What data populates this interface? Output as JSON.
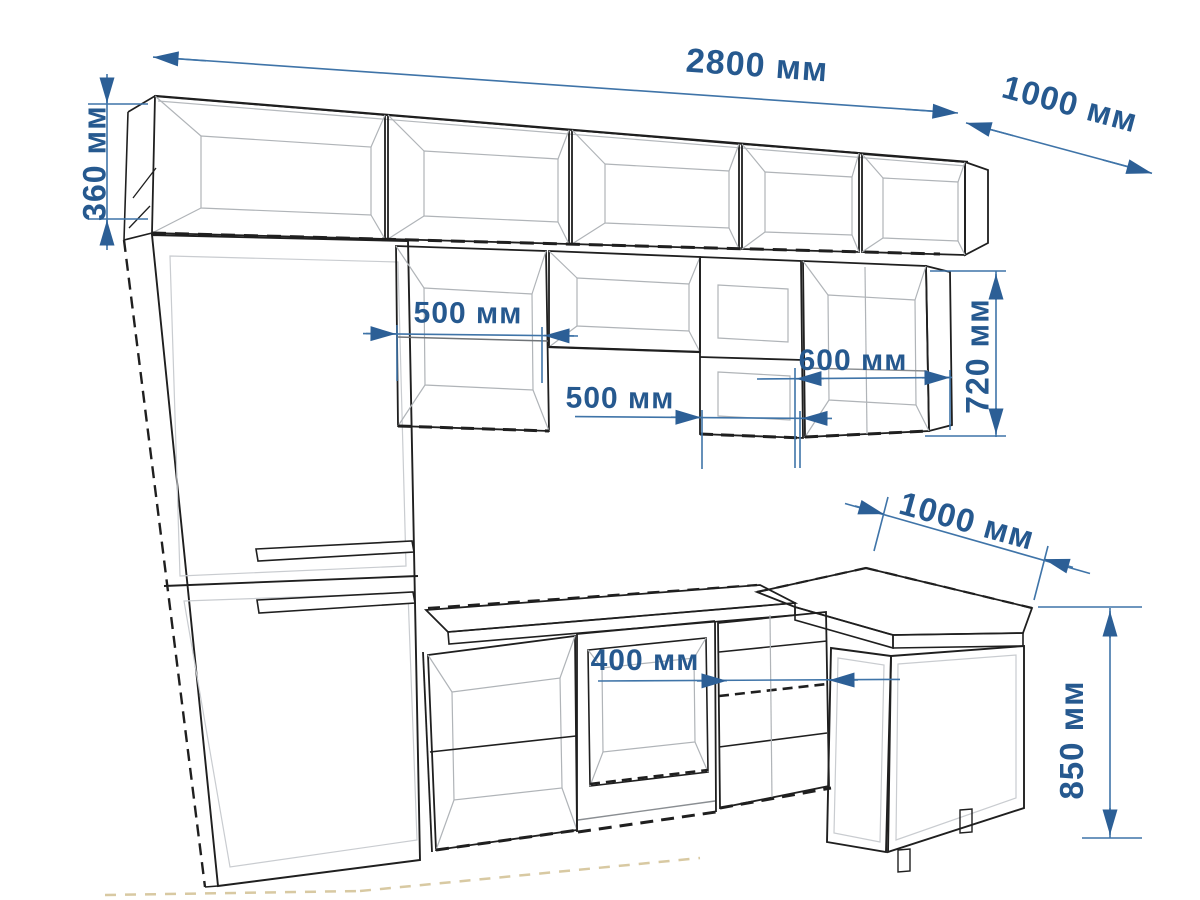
{
  "diagram": {
    "kind": "kitchen-furniture-dimension-drawing",
    "unit": "мм",
    "colors": {
      "dimension_blue": "#2c5f96",
      "dimension_line_blue": "#3f74a8",
      "drawing_black": "#1f1f1f",
      "background": "#ffffff"
    },
    "dimensions": [
      {
        "id": "total-run-width",
        "label": "2800 мм",
        "value": 2800
      },
      {
        "id": "right-return-depth",
        "label": "1000 мм",
        "value": 1000
      },
      {
        "id": "upper-cabinet-height",
        "label": "360 мм",
        "value": 360
      },
      {
        "id": "wall-cabinet-width-1",
        "label": "500 мм",
        "value": 500
      },
      {
        "id": "wall-cabinet-width-2",
        "label": "500 мм",
        "value": 500
      },
      {
        "id": "wall-cabinet-width-3",
        "label": "600 мм",
        "value": 600
      },
      {
        "id": "wall-cabinet-height",
        "label": "720 мм",
        "value": 720
      },
      {
        "id": "corner-worktop-width",
        "label": "1000 мм",
        "value": 1000
      },
      {
        "id": "base-cabinet-width",
        "label": "400 мм",
        "value": 400
      },
      {
        "id": "worktop-height",
        "label": "850 мм",
        "value": 850
      }
    ]
  }
}
